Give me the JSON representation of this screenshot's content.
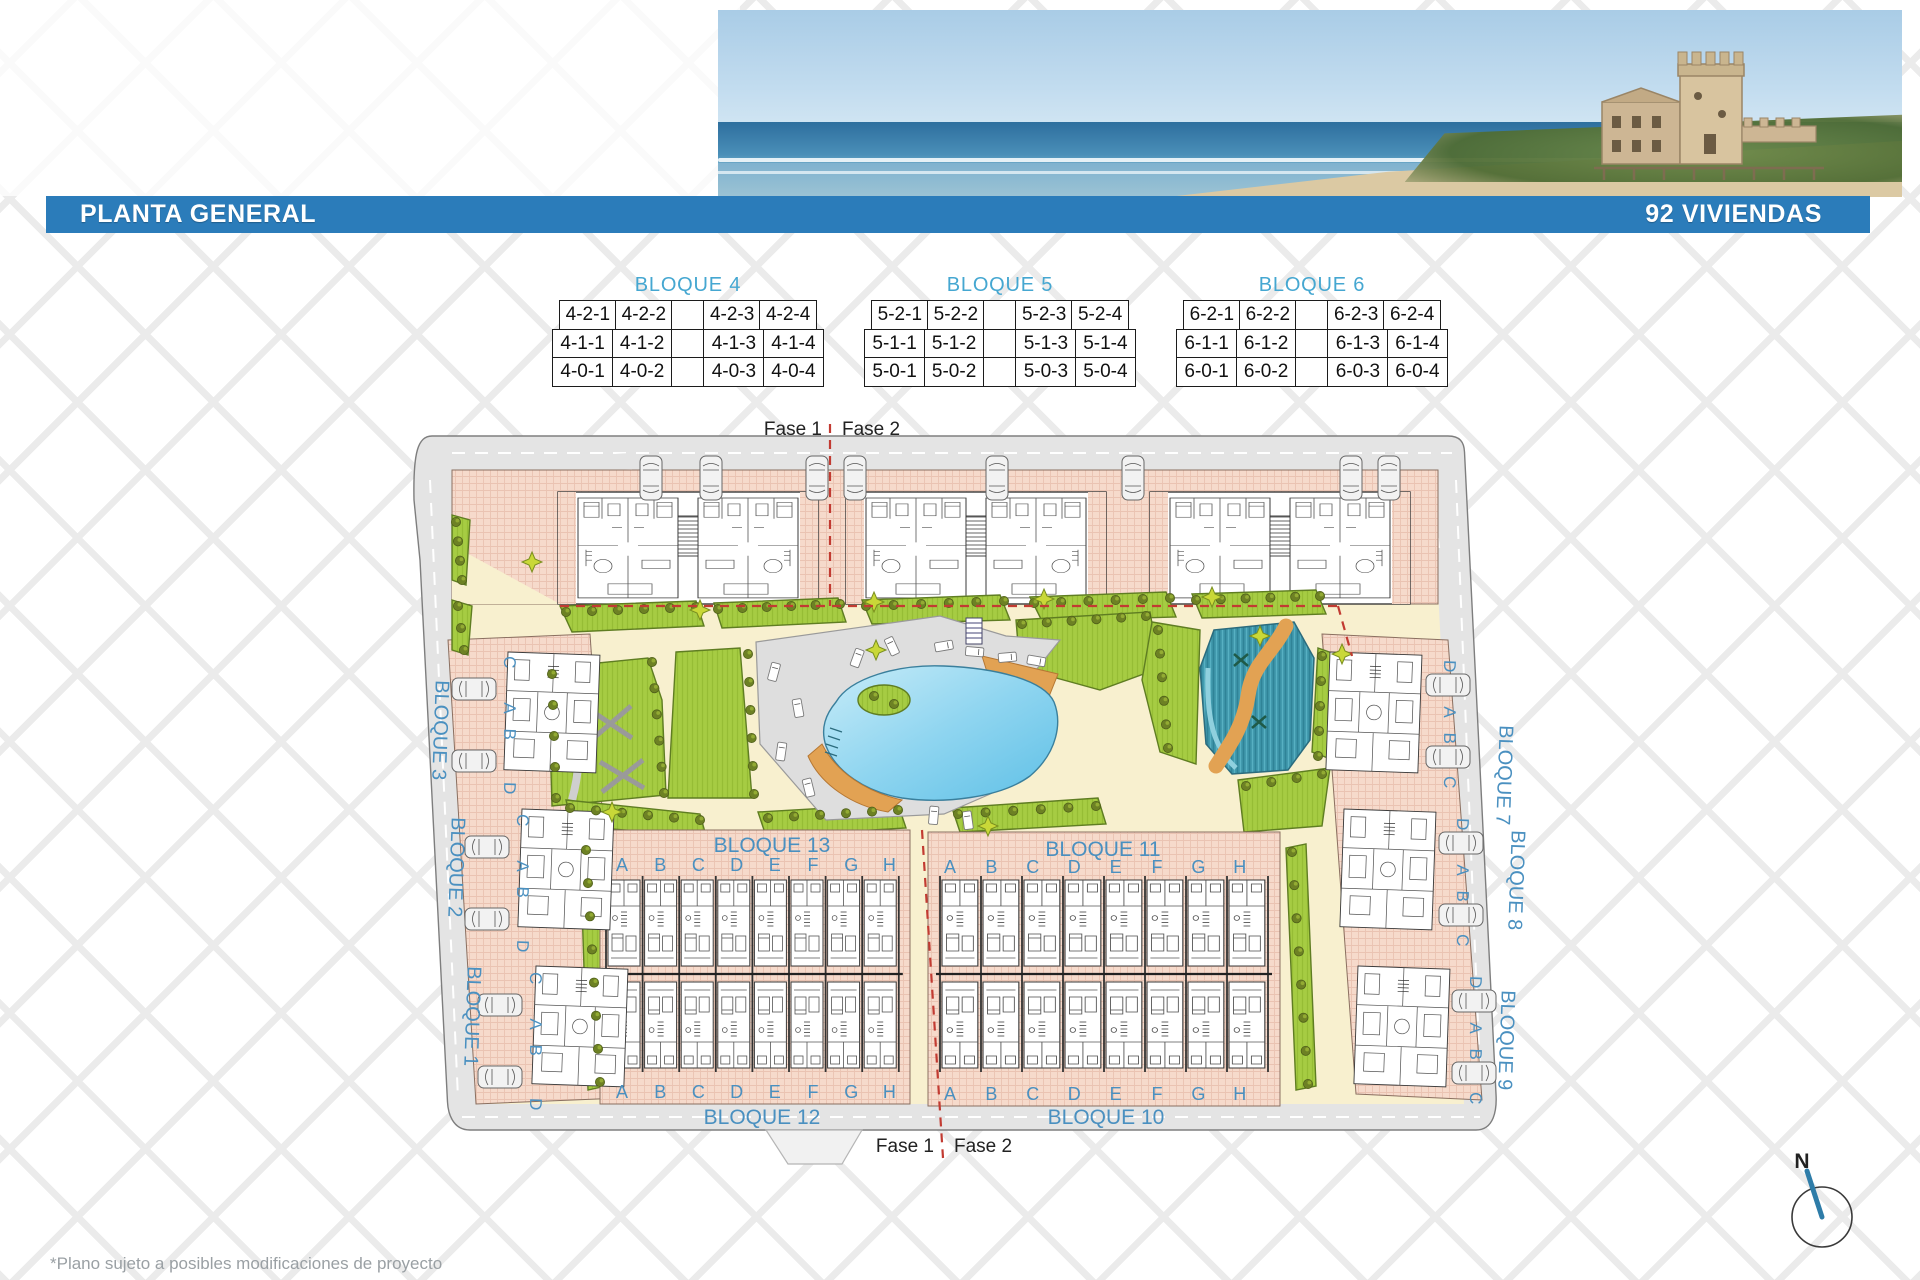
{
  "header": {
    "title": "PLANTA GENERAL",
    "units_count": "92 VIVIENDAS"
  },
  "tables": [
    {
      "title": "BLOQUE 4",
      "rows": [
        [
          "4-2-1",
          "4-2-2",
          "",
          "4-2-3",
          "4-2-4"
        ],
        [
          "4-1-1",
          "4-1-2",
          "",
          "4-1-3",
          "4-1-4"
        ],
        [
          "4-0-1",
          "4-0-2",
          "",
          "4-0-3",
          "4-0-4"
        ]
      ]
    },
    {
      "title": "BLOQUE 5",
      "rows": [
        [
          "5-2-1",
          "5-2-2",
          "",
          "5-2-3",
          "5-2-4"
        ],
        [
          "5-1-1",
          "5-1-2",
          "",
          "5-1-3",
          "5-1-4"
        ],
        [
          "5-0-1",
          "5-0-2",
          "",
          "5-0-3",
          "5-0-4"
        ]
      ]
    },
    {
      "title": "BLOQUE 6",
      "rows": [
        [
          "6-2-1",
          "6-2-2",
          "",
          "6-2-3",
          "6-2-4"
        ],
        [
          "6-1-1",
          "6-1-2",
          "",
          "6-1-3",
          "6-1-4"
        ],
        [
          "6-0-1",
          "6-0-2",
          "",
          "6-0-3",
          "6-0-4"
        ]
      ]
    }
  ],
  "plan": {
    "phase_labels": {
      "fase1": "Fase 1",
      "fase2": "Fase 2"
    },
    "left_blocks": [
      "BLOQUE 3",
      "BLOQUE 2",
      "BLOQUE 1"
    ],
    "right_blocks": [
      "BLOQUE 7",
      "BLOQUE 8",
      "BLOQUE 9"
    ],
    "inner_titles": {
      "bottom_left_top": "BLOQUE 13",
      "bottom_right_top": "BLOQUE 11",
      "bottom_left_bottom": "BLOQUE 12",
      "bottom_right_bottom": "BLOQUE 10"
    },
    "unit_letters": [
      "A",
      "B",
      "C",
      "D",
      "E",
      "F",
      "G",
      "H"
    ],
    "left_cluster_letters": [
      "C",
      "A",
      "B",
      "D"
    ],
    "right_cluster_letters": [
      "D",
      "A",
      "B",
      "C"
    ],
    "compass_north": "N"
  },
  "footer": {
    "note": "*Plano sujeto a posibles modificaciones de proyecto"
  },
  "colors": {
    "accent_blue": "#2b7cba",
    "table_title_blue": "#45a7d1",
    "label_blue": "#4a90c0",
    "phase_red": "#c23b32",
    "road_gray": "#e4e4e4",
    "path_cream": "#f8f0cf",
    "building_pink": "#f6dacb",
    "lawn_green": "#a6cc43",
    "pool_blue": "#7ccdec",
    "river_teal": "#3f98ac",
    "deck_orange": "#e2a253"
  }
}
